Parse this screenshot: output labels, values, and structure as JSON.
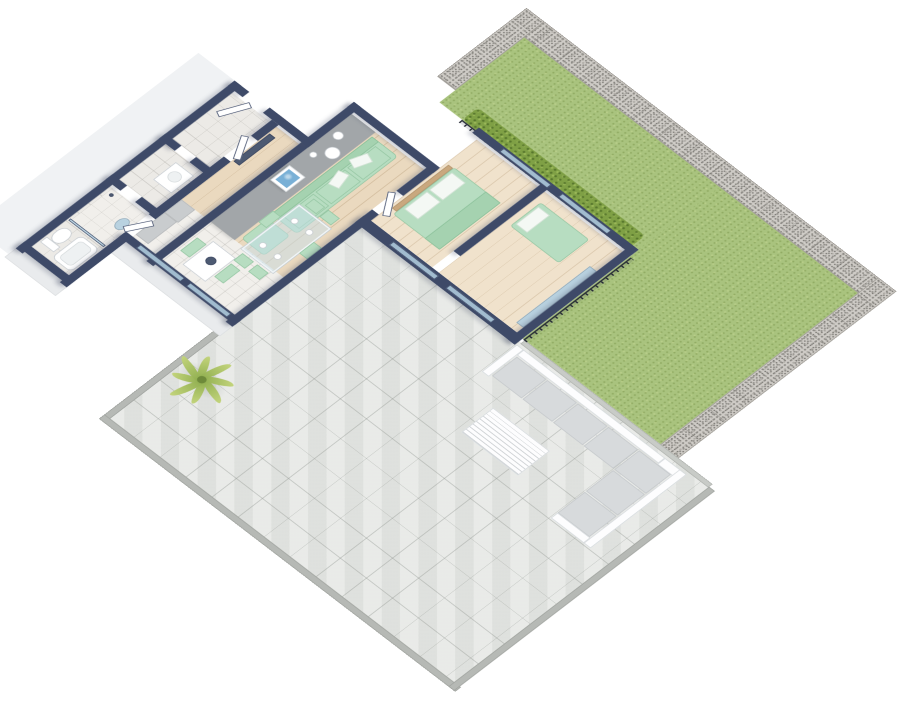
{
  "scene": {
    "description": "3D isometric floor plan render of an apartment with garden lawn, gabion stone walls and tiled terrace",
    "palette": {
      "navy": "#3e4a68",
      "mint": "#b7ddc1",
      "lawn": "#a9c37e",
      "hedge": "#7fa045",
      "gabion": "#cfccc7",
      "terrace": "#e4e6e3",
      "wood": "#ead9bf",
      "accent": "#a2a6a9",
      "glass": "rgba(186,216,232,0.8)",
      "art": "#79b0d6",
      "rail": "#262b36",
      "curb": "#b6b9b5",
      "background": "#ffffff"
    },
    "projection": {
      "tx": 298,
      "ty": -136,
      "scale": 0.8,
      "rotateX": 40,
      "rotateZ": 45
    },
    "elements": [
      {
        "n": "ground-slab-west",
        "c": "facade-light",
        "x": 130,
        "y": 306,
        "w": 64,
        "h": 400
      },
      {
        "n": "garden-lawn-main",
        "c": "lawn",
        "x": 400,
        "y": 0,
        "w": 590,
        "h": 150
      },
      {
        "n": "garden-lawn-east",
        "c": "lawn",
        "x": 746,
        "y": 0,
        "w": 244,
        "h": 349
      },
      {
        "n": "gabion-wall-top",
        "c": "gabion",
        "x": 368,
        "y": -36,
        "w": 652,
        "h": 36
      },
      {
        "n": "gabion-wall-left",
        "c": "gabion gabion-v",
        "x": 368,
        "y": -36,
        "w": 32,
        "h": 158
      },
      {
        "n": "gabion-wall-right",
        "c": "gabion gabion-v",
        "x": 990,
        "y": -36,
        "w": 32,
        "h": 391
      },
      {
        "n": "hedge-strip",
        "c": "hedge",
        "x": 440,
        "y": 122,
        "w": 296,
        "h": 28
      },
      {
        "n": "railing-hedge",
        "c": "railing-x",
        "x": 440,
        "y": 150,
        "w": 300,
        "h": 6
      },
      {
        "n": "terrace-floor",
        "c": "terrace",
        "x": 470,
        "y": 355,
        "w": 620,
        "h": 455
      },
      {
        "n": "terrace-curb-lawn",
        "c": "curb-light",
        "x": 750,
        "y": 349,
        "w": 332,
        "h": 8
      },
      {
        "n": "terrace-curb-west",
        "c": "curb",
        "x": 464,
        "y": 586,
        "w": 10,
        "h": 228
      },
      {
        "n": "terrace-curb-south",
        "c": "curb",
        "x": 464,
        "y": 806,
        "w": 630,
        "h": 10
      },
      {
        "n": "terrace-curb-east",
        "c": "curb",
        "x": 1082,
        "y": 355,
        "w": 10,
        "h": 461
      },
      {
        "n": "railing-lawn-west",
        "c": "railing-y",
        "x": 748,
        "y": 160,
        "w": 6,
        "h": 190
      },
      {
        "n": "palm-shadow",
        "c": "shadow-e",
        "x": 468,
        "y": 658,
        "w": 84,
        "h": 46,
        "r": "50%"
      },
      {
        "n": "lounge-back-north",
        "c": "white-furn",
        "x": 760,
        "y": 361,
        "w": 250,
        "h": 12
      },
      {
        "n": "lounge-arm-west",
        "c": "white-furn",
        "x": 748,
        "y": 361,
        "w": 12,
        "h": 62
      },
      {
        "n": "lounge-seat-1",
        "c": "cushion",
        "x": 762,
        "y": 375,
        "w": 52,
        "h": 44
      },
      {
        "n": "lounge-seat-2",
        "c": "cushion",
        "x": 816,
        "y": 375,
        "w": 52,
        "h": 44
      },
      {
        "n": "lounge-seat-3",
        "c": "cushion",
        "x": 870,
        "y": 375,
        "w": 52,
        "h": 44
      },
      {
        "n": "lounge-seat-4",
        "c": "cushion",
        "x": 924,
        "y": 375,
        "w": 52,
        "h": 44
      },
      {
        "n": "lounge-back-corner",
        "c": "white-furn",
        "x": 1010,
        "y": 361,
        "w": 38,
        "h": 14
      },
      {
        "n": "lounge-back-east",
        "c": "white-furn",
        "x": 1036,
        "y": 361,
        "w": 12,
        "h": 170
      },
      {
        "n": "lounge-seat-corner",
        "c": "cushion",
        "x": 978,
        "y": 375,
        "w": 56,
        "h": 44
      },
      {
        "n": "lounge-seat-5",
        "c": "cushion",
        "x": 978,
        "y": 421,
        "w": 56,
        "h": 48
      },
      {
        "n": "lounge-seat-6",
        "c": "cushion",
        "x": 978,
        "y": 471,
        "w": 56,
        "h": 48
      },
      {
        "n": "lounge-arm-south",
        "c": "white-furn",
        "x": 978,
        "y": 519,
        "w": 58,
        "h": 12
      },
      {
        "n": "coffee-table",
        "c": "white-furn slats",
        "x": 800,
        "y": 455,
        "w": 100,
        "h": 56
      },
      {
        "n": "palm-plant",
        "c": "palm",
        "x": 468,
        "y": 638,
        "w": 84,
        "h": 84
      },
      {
        "n": "facade-south-kitchen",
        "c": "facade",
        "x": 272,
        "y": 588,
        "w": 204,
        "h": 26
      },
      {
        "n": "facade-south-bath",
        "c": "facade",
        "x": 194,
        "y": 689,
        "w": 90,
        "h": 24
      },
      {
        "n": "floor-living-room",
        "c": "wood",
        "x": 336,
        "y": 241,
        "w": 128,
        "h": 249
      },
      {
        "n": "floor-kitchen",
        "c": "tile-light",
        "x": 284,
        "y": 490,
        "w": 180,
        "h": 86
      },
      {
        "n": "floor-corridor",
        "c": "wood",
        "x": 284,
        "y": 322,
        "w": 40,
        "h": 168
      },
      {
        "n": "floor-entrance-hall",
        "c": "tile",
        "x": 206,
        "y": 322,
        "w": 66,
        "h": 106
      },
      {
        "n": "floor-utility-room",
        "c": "tile",
        "x": 206,
        "y": 440,
        "w": 66,
        "h": 82
      },
      {
        "n": "floor-bathroom",
        "c": "tile",
        "x": 206,
        "y": 538,
        "w": 66,
        "h": 139
      },
      {
        "n": "floor-bedroom-double",
        "c": "wood-light",
        "x": 476,
        "y": 160,
        "w": 108,
        "h": 187
      },
      {
        "n": "floor-bedroom-single",
        "c": "wood-light",
        "x": 596,
        "y": 160,
        "w": 138,
        "h": 187
      },
      {
        "n": "accent-wall-face",
        "c": "gray-band",
        "x": 336,
        "y": 241,
        "w": 42,
        "h": 249
      },
      {
        "n": "wall-deco-circle-1",
        "c": "white-box",
        "x": 342,
        "y": 271,
        "w": 14,
        "h": 14,
        "r": "50%"
      },
      {
        "n": "wall-deco-circle-2",
        "c": "white-box",
        "x": 354,
        "y": 293,
        "w": 20,
        "h": 20,
        "r": "50%"
      },
      {
        "n": "wall-deco-circle-3",
        "c": "white-box",
        "x": 344,
        "y": 317,
        "w": 10,
        "h": 10,
        "r": "50%"
      },
      {
        "n": "picture-frame",
        "c": "frame-white",
        "x": 340,
        "y": 355,
        "w": 28,
        "h": 34
      },
      {
        "n": "picture-art",
        "c": "art",
        "x": 344,
        "y": 360,
        "w": 20,
        "h": 24
      },
      {
        "n": "kitchen-cabinet",
        "c": "counter",
        "x": 284,
        "y": 490,
        "w": 24,
        "h": 30
      },
      {
        "n": "kitchen-counter",
        "c": "counter",
        "x": 284,
        "y": 520,
        "w": 22,
        "h": 51
      },
      {
        "n": "kitchen-table",
        "c": "white-box",
        "x": 360,
        "y": 510,
        "w": 40,
        "h": 54
      },
      {
        "n": "kitchen-bowl",
        "c": "dark-panel",
        "x": 374,
        "y": 528,
        "w": 14,
        "h": 14,
        "r": "50%"
      },
      {
        "n": "kitchen-chair-west",
        "c": "mint",
        "x": 342,
        "y": 520,
        "w": 16,
        "h": 30
      },
      {
        "n": "kitchen-chair-east",
        "c": "mint",
        "x": 402,
        "y": 520,
        "w": 16,
        "h": 30
      },
      {
        "n": "sofa-base",
        "c": "mint",
        "x": 380,
        "y": 249,
        "w": 46,
        "h": 179,
        "r": "6px"
      },
      {
        "n": "sofa-back",
        "c": "mint-dark",
        "x": 380,
        "y": 249,
        "w": 12,
        "h": 179
      },
      {
        "n": "sofa-cushion-1",
        "c": "mint",
        "x": 394,
        "y": 257,
        "w": 28,
        "h": 50
      },
      {
        "n": "sofa-cushion-2",
        "c": "mint",
        "x": 394,
        "y": 311,
        "w": 28,
        "h": 52
      },
      {
        "n": "sofa-cushion-3",
        "c": "mint",
        "x": 394,
        "y": 367,
        "w": 28,
        "h": 53
      },
      {
        "n": "sofa-pillow-1",
        "c": "pillow",
        "x": 390,
        "y": 274,
        "w": 16,
        "h": 26,
        "rot": 20
      },
      {
        "n": "sofa-pillow-2",
        "c": "pillow",
        "x": 392,
        "y": 315,
        "w": 16,
        "h": 26,
        "rot": -15
      },
      {
        "n": "sofa-ottoman",
        "c": "mint",
        "x": 382,
        "y": 436,
        "w": 40,
        "h": 46,
        "r": "5px"
      },
      {
        "n": "dining-table",
        "c": "glass-top",
        "x": 394,
        "y": 392,
        "w": 56,
        "h": 102
      },
      {
        "n": "dining-plate-1",
        "c": "white-box",
        "x": 404,
        "y": 410,
        "w": 10,
        "h": 10,
        "r": "50%"
      },
      {
        "n": "dining-plate-2",
        "c": "white-box",
        "x": 430,
        "y": 410,
        "w": 10,
        "h": 10,
        "r": "50%"
      },
      {
        "n": "dining-plate-3",
        "c": "white-box",
        "x": 404,
        "y": 466,
        "w": 10,
        "h": 10,
        "r": "50%"
      },
      {
        "n": "dining-plate-4",
        "c": "white-box",
        "x": 430,
        "y": 466,
        "w": 10,
        "h": 10,
        "r": "50%"
      },
      {
        "n": "dining-chair-n1",
        "c": "mint",
        "x": 400,
        "y": 372,
        "w": 20,
        "h": 16
      },
      {
        "n": "dining-chair-n2",
        "c": "mint",
        "x": 426,
        "y": 372,
        "w": 20,
        "h": 16
      },
      {
        "n": "dining-chair-s1",
        "c": "mint",
        "x": 400,
        "y": 498,
        "w": 20,
        "h": 16
      },
      {
        "n": "dining-chair-s2",
        "c": "mint",
        "x": 426,
        "y": 498,
        "w": 20,
        "h": 16
      },
      {
        "n": "dining-chair-w",
        "c": "mint",
        "x": 378,
        "y": 422,
        "w": 14,
        "h": 26
      },
      {
        "n": "dining-chair-e",
        "c": "mint",
        "x": 450,
        "y": 422,
        "w": 14,
        "h": 26
      },
      {
        "n": "bed-double-headboard",
        "c": "headboard",
        "x": 480,
        "y": 214,
        "w": 8,
        "h": 100
      },
      {
        "n": "bed-double",
        "c": "mint",
        "x": 488,
        "y": 212,
        "w": 82,
        "h": 108,
        "r": "4px"
      },
      {
        "n": "bed-double-pillow-1",
        "c": "pillow",
        "x": 492,
        "y": 220,
        "w": 24,
        "h": 40
      },
      {
        "n": "bed-double-pillow-2",
        "c": "pillow",
        "x": 492,
        "y": 264,
        "w": 24,
        "h": 40
      },
      {
        "n": "bed-double-throw",
        "c": "mint-dark",
        "x": 544,
        "y": 212,
        "w": 26,
        "h": 108
      },
      {
        "n": "bed-single",
        "c": "mint",
        "x": 605,
        "y": 176,
        "w": 86,
        "h": 54,
        "r": "4px"
      },
      {
        "n": "bed-single-pillow",
        "c": "pillow",
        "x": 608,
        "y": 183,
        "w": 20,
        "h": 40
      },
      {
        "n": "wardrobe-mirror",
        "c": "mirror",
        "x": 722,
        "y": 206,
        "w": 12,
        "h": 130
      },
      {
        "n": "corridor-wardrobe",
        "c": "dark-panel",
        "x": 286,
        "y": 336,
        "w": 10,
        "h": 64
      },
      {
        "n": "shower-floor",
        "c": "tile-light",
        "x": 210,
        "y": 538,
        "w": 60,
        "h": 74
      },
      {
        "n": "shower-glass",
        "c": "glass",
        "x": 208,
        "y": 610,
        "w": 62,
        "h": 4
      },
      {
        "n": "shower-head",
        "c": "dark-panel",
        "x": 214,
        "y": 544,
        "w": 6,
        "h": 6,
        "r": "50%"
      },
      {
        "n": "toilet-bowl",
        "c": "white-box",
        "x": 210,
        "y": 624,
        "w": 20,
        "h": 28,
        "r": "45%"
      },
      {
        "n": "toilet-cistern",
        "c": "white-box",
        "x": 208,
        "y": 652,
        "w": 24,
        "h": 12
      },
      {
        "n": "bathtub",
        "c": "white-box",
        "x": 236,
        "y": 620,
        "w": 34,
        "h": 52,
        "r": "8px"
      },
      {
        "n": "bathtub-inner",
        "c": "basin",
        "x": 242,
        "y": 626,
        "w": 22,
        "h": 40,
        "r": "6px"
      },
      {
        "n": "bathroom-mirror",
        "c": "mirror",
        "x": 252,
        "y": 560,
        "w": 16,
        "h": 22,
        "r": "50%"
      },
      {
        "n": "washing-machine",
        "c": "white-box",
        "x": 236,
        "y": 452,
        "w": 32,
        "h": 40
      },
      {
        "n": "washer-door",
        "c": "basin",
        "x": 243,
        "y": 461,
        "w": 18,
        "h": 18,
        "r": "50%"
      },
      {
        "n": "wall-bedwing-north",
        "c": "navy",
        "x": 464,
        "y": 144,
        "w": 282,
        "h": 12
      },
      {
        "n": "wall-bedwing-east",
        "c": "navy",
        "x": 734,
        "y": 144,
        "w": 12,
        "h": 219
      },
      {
        "n": "wall-bedwing-south",
        "c": "navy",
        "x": 464,
        "y": 347,
        "w": 282,
        "h": 16
      },
      {
        "n": "wall-bedroom-divider",
        "c": "navy",
        "x": 584,
        "y": 152,
        "w": 12,
        "h": 157
      },
      {
        "n": "wall-living-east-north",
        "c": "navy",
        "x": 464,
        "y": 228,
        "w": 12,
        "h": 62
      },
      {
        "n": "wall-living-east-south",
        "c": "navy",
        "x": 464,
        "y": 333,
        "w": 12,
        "h": 259
      },
      {
        "n": "wall-living-north",
        "c": "navy",
        "x": 324,
        "y": 225,
        "w": 152,
        "h": 12
      },
      {
        "n": "wall-accent-core",
        "c": "navy",
        "x": 324,
        "y": 225,
        "w": 12,
        "h": 367
      },
      {
        "n": "wall-corridor-north",
        "c": "navy",
        "x": 272,
        "y": 306,
        "w": 64,
        "h": 12
      },
      {
        "n": "wall-entrance-north-1",
        "c": "navy",
        "x": 194,
        "y": 306,
        "w": 26,
        "h": 12
      },
      {
        "n": "wall-entrance-north-2",
        "c": "navy",
        "x": 256,
        "y": 306,
        "w": 28,
        "h": 12
      },
      {
        "n": "wall-west-exterior",
        "c": "navy",
        "x": 194,
        "y": 306,
        "w": 12,
        "h": 387
      },
      {
        "n": "wall-mid-east-1",
        "c": "navy",
        "x": 272,
        "y": 318,
        "w": 12,
        "h": 37
      },
      {
        "n": "wall-mid-east-2",
        "c": "navy",
        "x": 272,
        "y": 403,
        "w": 12,
        "h": 133
      },
      {
        "n": "wall-mid-east-3",
        "c": "navy",
        "x": 272,
        "y": 579,
        "w": 12,
        "h": 114
      },
      {
        "n": "wall-entry-utility-1",
        "c": "navy",
        "x": 194,
        "y": 428,
        "w": 28,
        "h": 12
      },
      {
        "n": "wall-entry-utility-2",
        "c": "navy",
        "x": 248,
        "y": 428,
        "w": 30,
        "h": 12
      },
      {
        "n": "wall-utility-bath-1",
        "c": "navy",
        "x": 194,
        "y": 522,
        "w": 26,
        "h": 12
      },
      {
        "n": "wall-utility-bath-2",
        "c": "navy",
        "x": 246,
        "y": 522,
        "w": 32,
        "h": 12
      },
      {
        "n": "wall-bath-south",
        "c": "navy",
        "x": 194,
        "y": 677,
        "w": 90,
        "h": 12
      },
      {
        "n": "wall-kitchen-south",
        "c": "navy",
        "x": 272,
        "y": 576,
        "w": 204,
        "h": 12
      },
      {
        "n": "slider-garden-1",
        "c": "glass",
        "x": 510,
        "y": 146,
        "w": 84,
        "h": 8
      },
      {
        "n": "slider-garden-2",
        "c": "glass",
        "x": 614,
        "y": 146,
        "w": 86,
        "h": 8
      },
      {
        "n": "slider-terrace-1",
        "c": "glass",
        "x": 520,
        "y": 351,
        "w": 80,
        "h": 8
      },
      {
        "n": "slider-terrace-2",
        "c": "glass",
        "x": 620,
        "y": 351,
        "w": 80,
        "h": 8
      },
      {
        "n": "slider-kitchen-1",
        "c": "glass",
        "x": 300,
        "y": 578,
        "w": 78,
        "h": 8
      },
      {
        "n": "slider-kitchen-2",
        "c": "glass",
        "x": 388,
        "y": 578,
        "w": 72,
        "h": 8
      },
      {
        "n": "door-entrance",
        "c": "leaf-door",
        "x": 222,
        "y": 318,
        "w": 10,
        "h": 44,
        "rot": 25
      },
      {
        "n": "door-hall",
        "c": "leaf-door",
        "x": 272,
        "y": 358,
        "w": 10,
        "h": 40,
        "rot": -30
      },
      {
        "n": "door-bathroom",
        "c": "leaf-door",
        "x": 272,
        "y": 540,
        "w": 10,
        "h": 38,
        "rot": 30
      },
      {
        "n": "door-bedroom-double",
        "c": "leaf-door",
        "x": 468,
        "y": 292,
        "w": 10,
        "h": 40,
        "rot": -35
      }
    ]
  }
}
